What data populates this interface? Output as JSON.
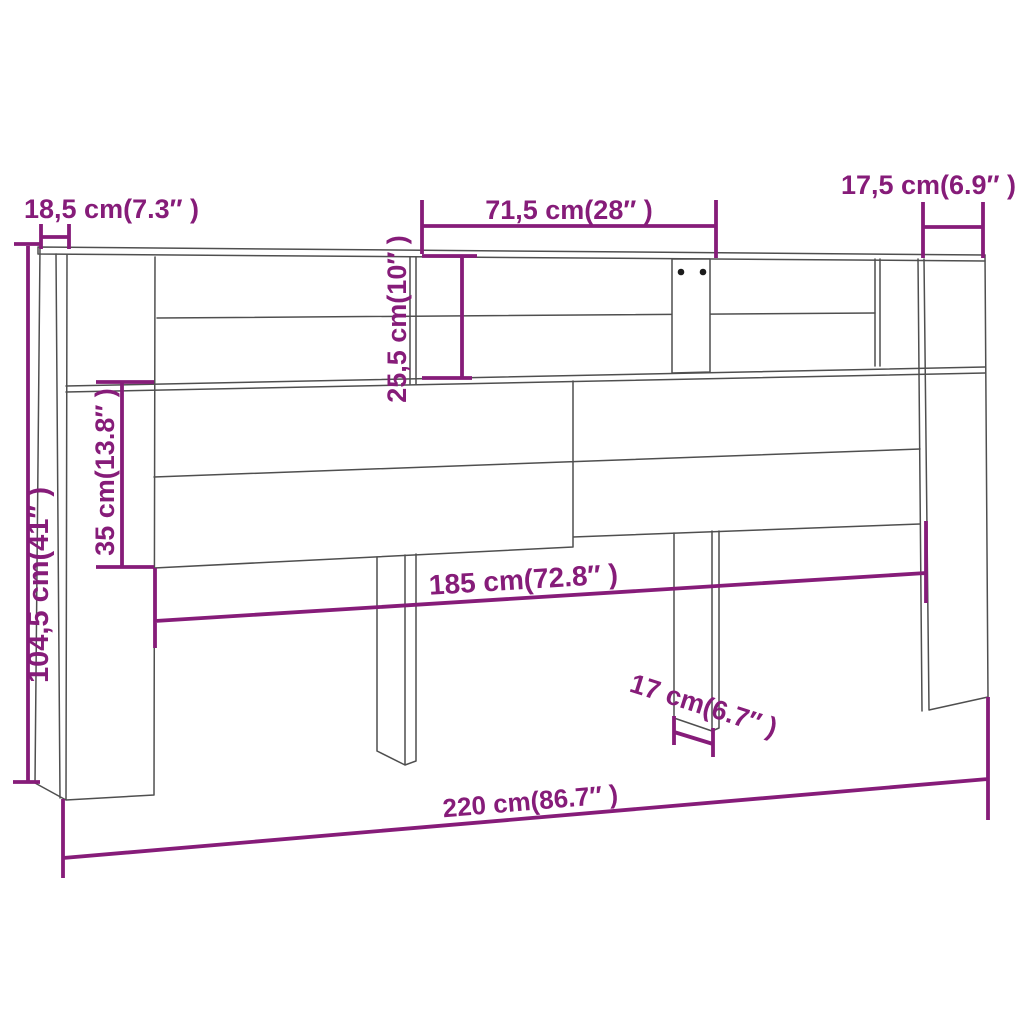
{
  "figure": {
    "kind": "furniture-dimension-diagram",
    "subject": "headboard cabinet line drawing",
    "background_color": "#ffffff",
    "line_color": "#4f4f4f",
    "dimension_color": "#861c79",
    "hole_dot_color": "#1c1c1c"
  },
  "dimensions": [
    {
      "id": "left-top-depth",
      "label": "18,5 cm(7.3″ )",
      "orientation": "horizontal"
    },
    {
      "id": "top-shelf-width",
      "label": "71,5 cm(28″ )",
      "orientation": "horizontal"
    },
    {
      "id": "right-top-depth",
      "label": "17,5 cm(6.9″ )",
      "orientation": "horizontal"
    },
    {
      "id": "total-height",
      "label": "104,5 cm(41″ )",
      "orientation": "vertical"
    },
    {
      "id": "front-panel-height",
      "label": "35 cm(13.8″ )",
      "orientation": "vertical"
    },
    {
      "id": "shelf-height",
      "label": "25,5 cm(10″ )",
      "orientation": "vertical"
    },
    {
      "id": "inner-width",
      "label": "185 cm(72.8″ )",
      "orientation": "horizontal"
    },
    {
      "id": "leg-width",
      "label": "17 cm(6.7″ )",
      "orientation": "horizontal"
    },
    {
      "id": "total-width",
      "label": "220 cm(86.7″ )",
      "orientation": "horizontal"
    }
  ]
}
